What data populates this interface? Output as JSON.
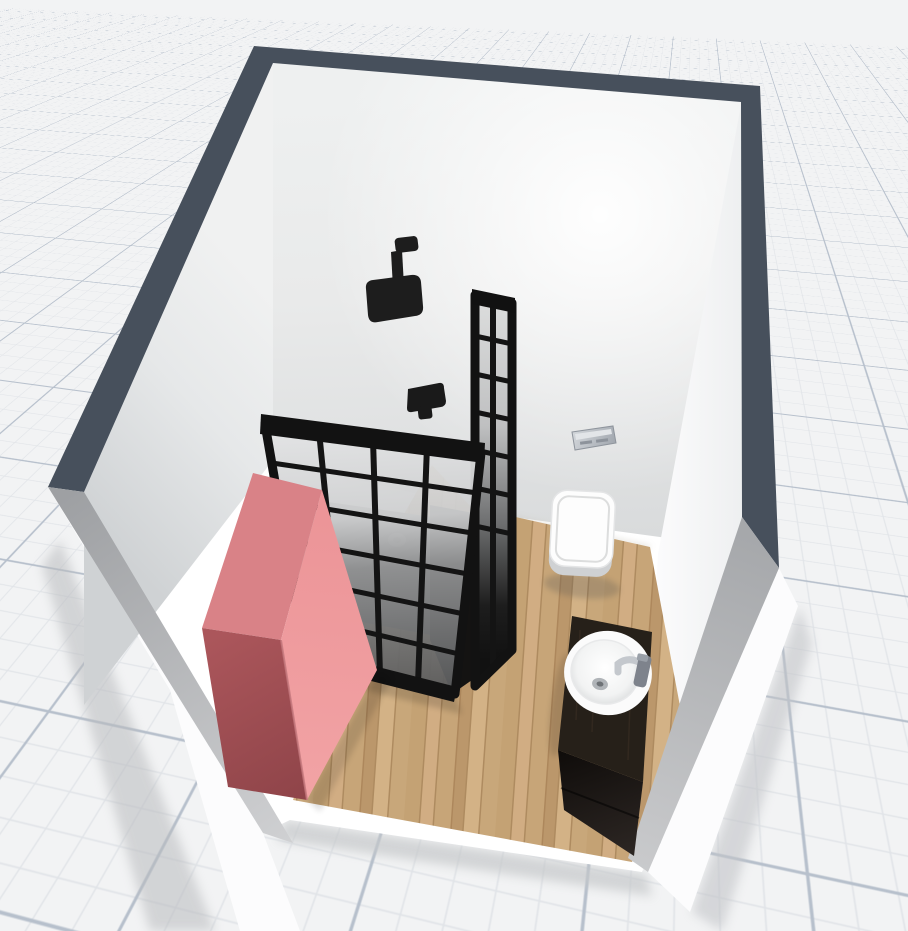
{
  "app": {
    "viewport": "3d-room-view",
    "canvas": {
      "width": 908,
      "height": 931
    }
  },
  "colors": {
    "grid_bg": "#f2f3f4",
    "grid_minor": "#e1e4e8",
    "grid_major": "#b7c0cc",
    "wall_top": "#47505c",
    "wall_left_interior": "#e4e6e7",
    "wall_back_interior": "#eceded",
    "wall_right_interior": "#f4f5f6",
    "cut_gray": "#b3b5b8",
    "exterior_white": "#fcfcfd",
    "room_white": "#ffffff",
    "wood_base": "#cfae82",
    "cabinet_top": "#d98287",
    "cabinet_light": "#ef9a9d",
    "cabinet_dark": "#a25055",
    "frame_black": "#161616",
    "tray_gray": "#747576",
    "drain_gray": "#9d9d9d",
    "porcelain": "#fdfdfd",
    "porcelain_shade": "#d0d2d4",
    "flush_plate": "#b6bac0",
    "counter_dark": "#262019",
    "counter_face": "#17110e",
    "chrome": "#c4c8cd",
    "chrome_dark": "#7e838c"
  },
  "css_vars": {
    "--grid-bg": "#f2f3f4",
    "--grid-minor": "#e1e4e8",
    "--grid-major": "#b7c0cc"
  },
  "scene": {
    "room": {
      "walls": 3,
      "wall_top_color": "#47505c",
      "open_side": "front"
    },
    "objects": [
      {
        "id": "wood-floor",
        "label": "wood flooring"
      },
      {
        "id": "wardrobe",
        "label": "coral wardrobe cabinet"
      },
      {
        "id": "shower-enclosure",
        "label": "black framed glass shower"
      },
      {
        "id": "shower-head",
        "label": "ceiling-arm rain shower head"
      },
      {
        "id": "shower-valve",
        "label": "shower mixer valve"
      },
      {
        "id": "toilet",
        "label": "wall-hung toilet"
      },
      {
        "id": "flush-plate",
        "label": "flush plate"
      },
      {
        "id": "vanity",
        "label": "dark vanity cabinet"
      },
      {
        "id": "sink",
        "label": "white oval sink"
      },
      {
        "id": "faucet",
        "label": "chrome faucet"
      }
    ]
  }
}
